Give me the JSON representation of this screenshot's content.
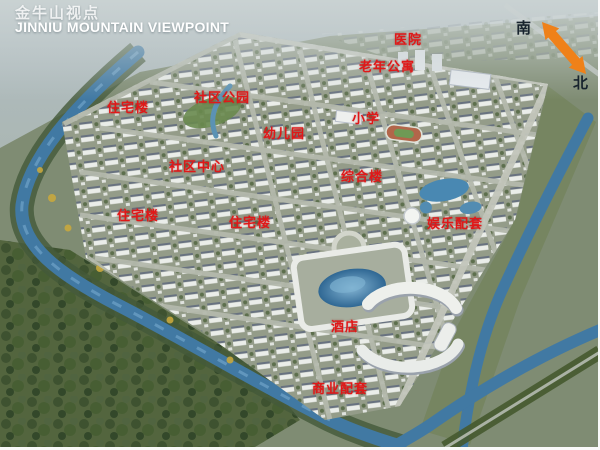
{
  "title": {
    "cn": "金牛山视点",
    "en": "JINNIU MOUNTAIN VIEWPOINT"
  },
  "compass": {
    "south": "南",
    "north": "北"
  },
  "labels": {
    "hospital": "医院",
    "senior_apartments": "老年公寓",
    "residential_nw": "住宅楼",
    "community_park": "社区公园",
    "kindergarten": "幼儿园",
    "primary_school": "小学",
    "community_center": "社区中心",
    "complex_building": "综合楼",
    "residential_w": "住宅楼",
    "residential_c": "住宅楼",
    "entertainment_amenities": "娱乐配套",
    "hotel": "酒店",
    "commercial_amenities": "商业配套"
  },
  "colors": {
    "label_red": "#e01818",
    "arrow_orange": "#ef8119",
    "water_blue": "#4179a3",
    "title_white": "#ffffff"
  }
}
